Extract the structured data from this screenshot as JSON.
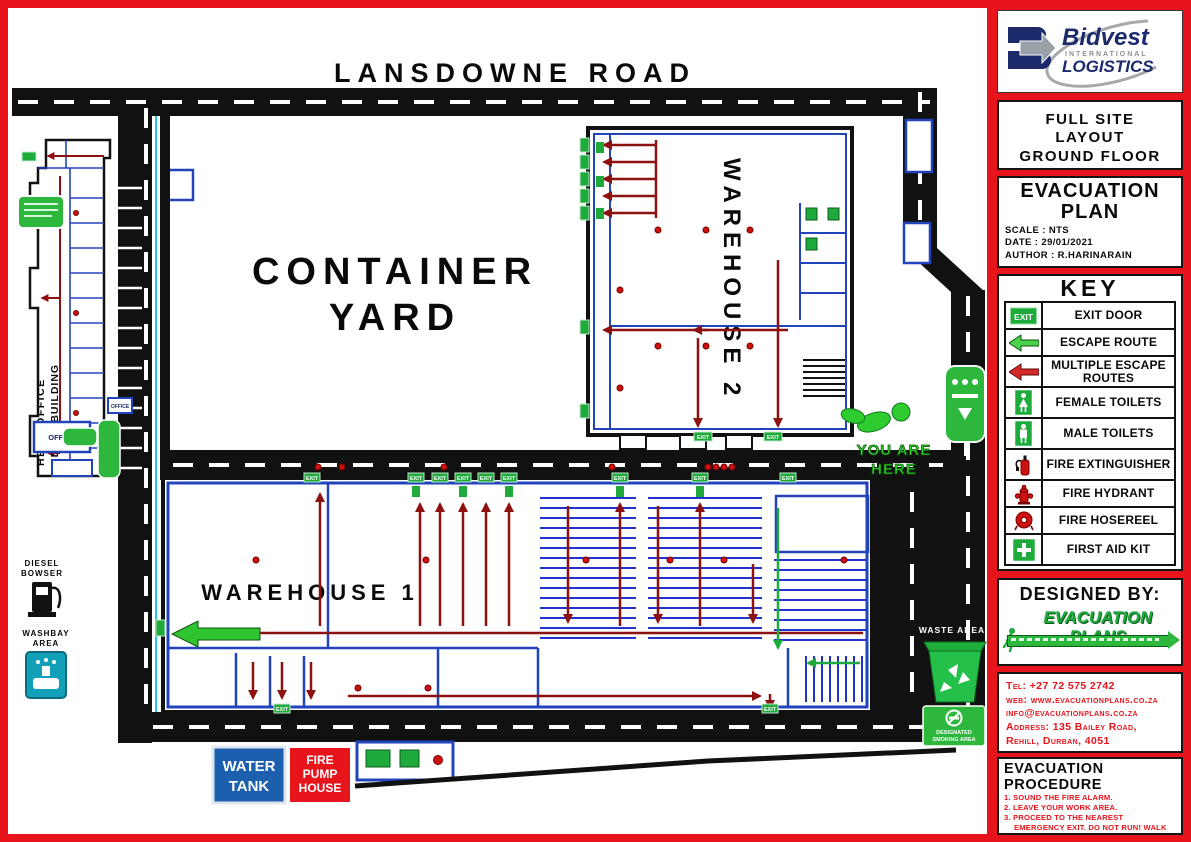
{
  "brand": {
    "name": "Bidvest",
    "line1": "INTERNATIONAL",
    "line2": "LOGISTICS"
  },
  "title_block": {
    "layout_lines": [
      "FULL SITE",
      "LAYOUT",
      "GROUND FLOOR"
    ],
    "plan_title_1": "EVACUATION",
    "plan_title_2": "PLAN",
    "scale": "SCALE : NTS",
    "date": "DATE : 29/01/2021",
    "author": "AUTHOR : R.HARINARAIN"
  },
  "key": {
    "title": "KEY",
    "exit_icon_text": "EXIT",
    "items": [
      {
        "icon": "exit-door-icon",
        "label": "EXIT DOOR"
      },
      {
        "icon": "escape-route-arrow-icon",
        "label": "ESCAPE ROUTE"
      },
      {
        "icon": "multiple-escape-routes-arrow-icon",
        "label": "MULTIPLE ESCAPE ROUTES"
      },
      {
        "icon": "female-toilets-icon",
        "label": "FEMALE TOILETS"
      },
      {
        "icon": "male-toilets-icon",
        "label": "MALE TOILETS"
      },
      {
        "icon": "fire-extinguisher-icon",
        "label": "FIRE EXTINGUISHER"
      },
      {
        "icon": "fire-hydrant-icon",
        "label": "FIRE HYDRANT"
      },
      {
        "icon": "fire-hosereel-icon",
        "label": "FIRE HOSEREEL"
      },
      {
        "icon": "first-aid-kit-icon",
        "label": "FIRST AID KIT"
      }
    ]
  },
  "designed_by": {
    "title": "DESIGNED BY:",
    "logo_text": "EVACUATION PLANS"
  },
  "contact": {
    "lines": [
      "Tel: +27 72 575 2742",
      "web: www.evacuationplans.co.za",
      "info@evacuationplans.co.za",
      "Address: 135 Bailey Road,",
      "Rehill, Durban, 4051"
    ]
  },
  "procedure": {
    "title": "EVACUATION PROCEDURE",
    "steps": [
      "1. SOUND THE FIRE ALARM.",
      "2. LEAVE YOUR WORK AREA.",
      "3. PROCEED TO THE NEAREST EMERGENCY EXIT. DO NOT RUN! WALK BRISKLY.",
      "4. ASSIST PHYSICALLY IMPAIRED INDIVIDUALS.",
      "5. PROCEED TO THE ASSEMBLY POINT LOCATED OUTSIDE"
    ]
  },
  "map": {
    "road_label": "LANSDOWNE ROAD",
    "container_yard_line1": "CONTAINER",
    "container_yard_line2": "YARD",
    "warehouse1_label": "WAREHOUSE 1",
    "warehouse2_label": "WAREHOUSE 2",
    "head_office_line1": "HEAD OFFICE",
    "head_office_line2": "ADMIN BUILDING",
    "you_are_here_line1": "YOU ARE",
    "you_are_here_line2": "HERE",
    "waste_area_label": "WASTE AREA",
    "smoking_line1": "DESIGNATED",
    "smoking_line2": "SMOKING AREA",
    "diesel_line1": "DIESEL",
    "diesel_line2": "BOWSER",
    "washbay_line1": "WASHBAY",
    "washbay_line2": "AREA",
    "water_tank_line1": "WATER",
    "water_tank_line2": "TANK",
    "fire_pump_line1": "FIRE",
    "fire_pump_line2": "PUMP",
    "fire_pump_line3": "HOUSE",
    "office_label": "OFFICE",
    "exit_label": "EXIT"
  },
  "colors": {
    "frame_red": "#e8141c",
    "route_red": "#8e1111",
    "wall_blue": "#2244bb",
    "cyan": "#1ec8e6",
    "sign_green": "#2db83d",
    "navy": "#1b2a6b"
  }
}
